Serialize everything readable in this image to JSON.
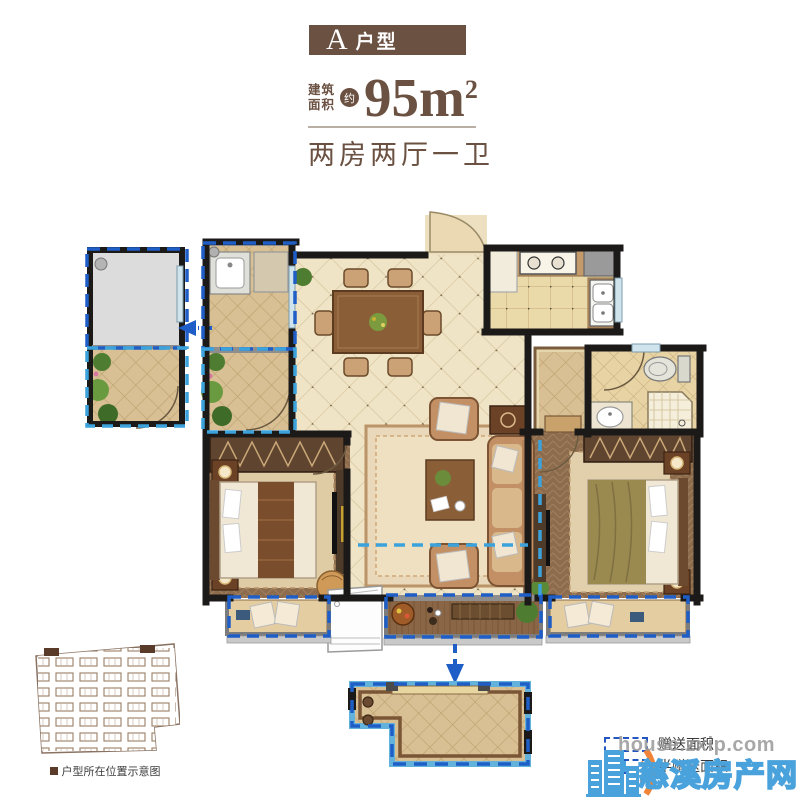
{
  "header": {
    "unit": {
      "letter": "A",
      "suffix": "户型"
    },
    "area": {
      "label_line1": "建筑",
      "label_line2": "面积",
      "approx": "约",
      "value": "95m",
      "superscript": "2"
    },
    "layout": "两房两厅一卫"
  },
  "legend": {
    "items": [
      {
        "label": "赠送面积",
        "style": "gift",
        "swatch": "blue-dashed-outline"
      },
      {
        "label": "半赠送面积",
        "style": "half-gift",
        "swatch": "blue-dashed-half-filled"
      }
    ]
  },
  "sitemap": {
    "caption": "户型所在位置示意图",
    "bullet": "■"
  },
  "watermark": {
    "domain": "house.zxip.com",
    "site_name": "慈溪房产网"
  },
  "colors": {
    "brand_brown": "#6b5142",
    "gift_area_blue": "#1e5ec6",
    "half_gift_area_blue": "#3ba2dc",
    "watermark_blue": "#4aa2dc",
    "watermark_orange": "#f08438",
    "floor_tile_beige": "#efe4c6",
    "bedroom_floor_brown": "#8d6b4d",
    "wall_black": "#1c1a18"
  },
  "icons": {
    "gift_arrow_left": "left-arrow",
    "gift_arrow_down": "down-arrow",
    "location_marker": "filled-square"
  }
}
